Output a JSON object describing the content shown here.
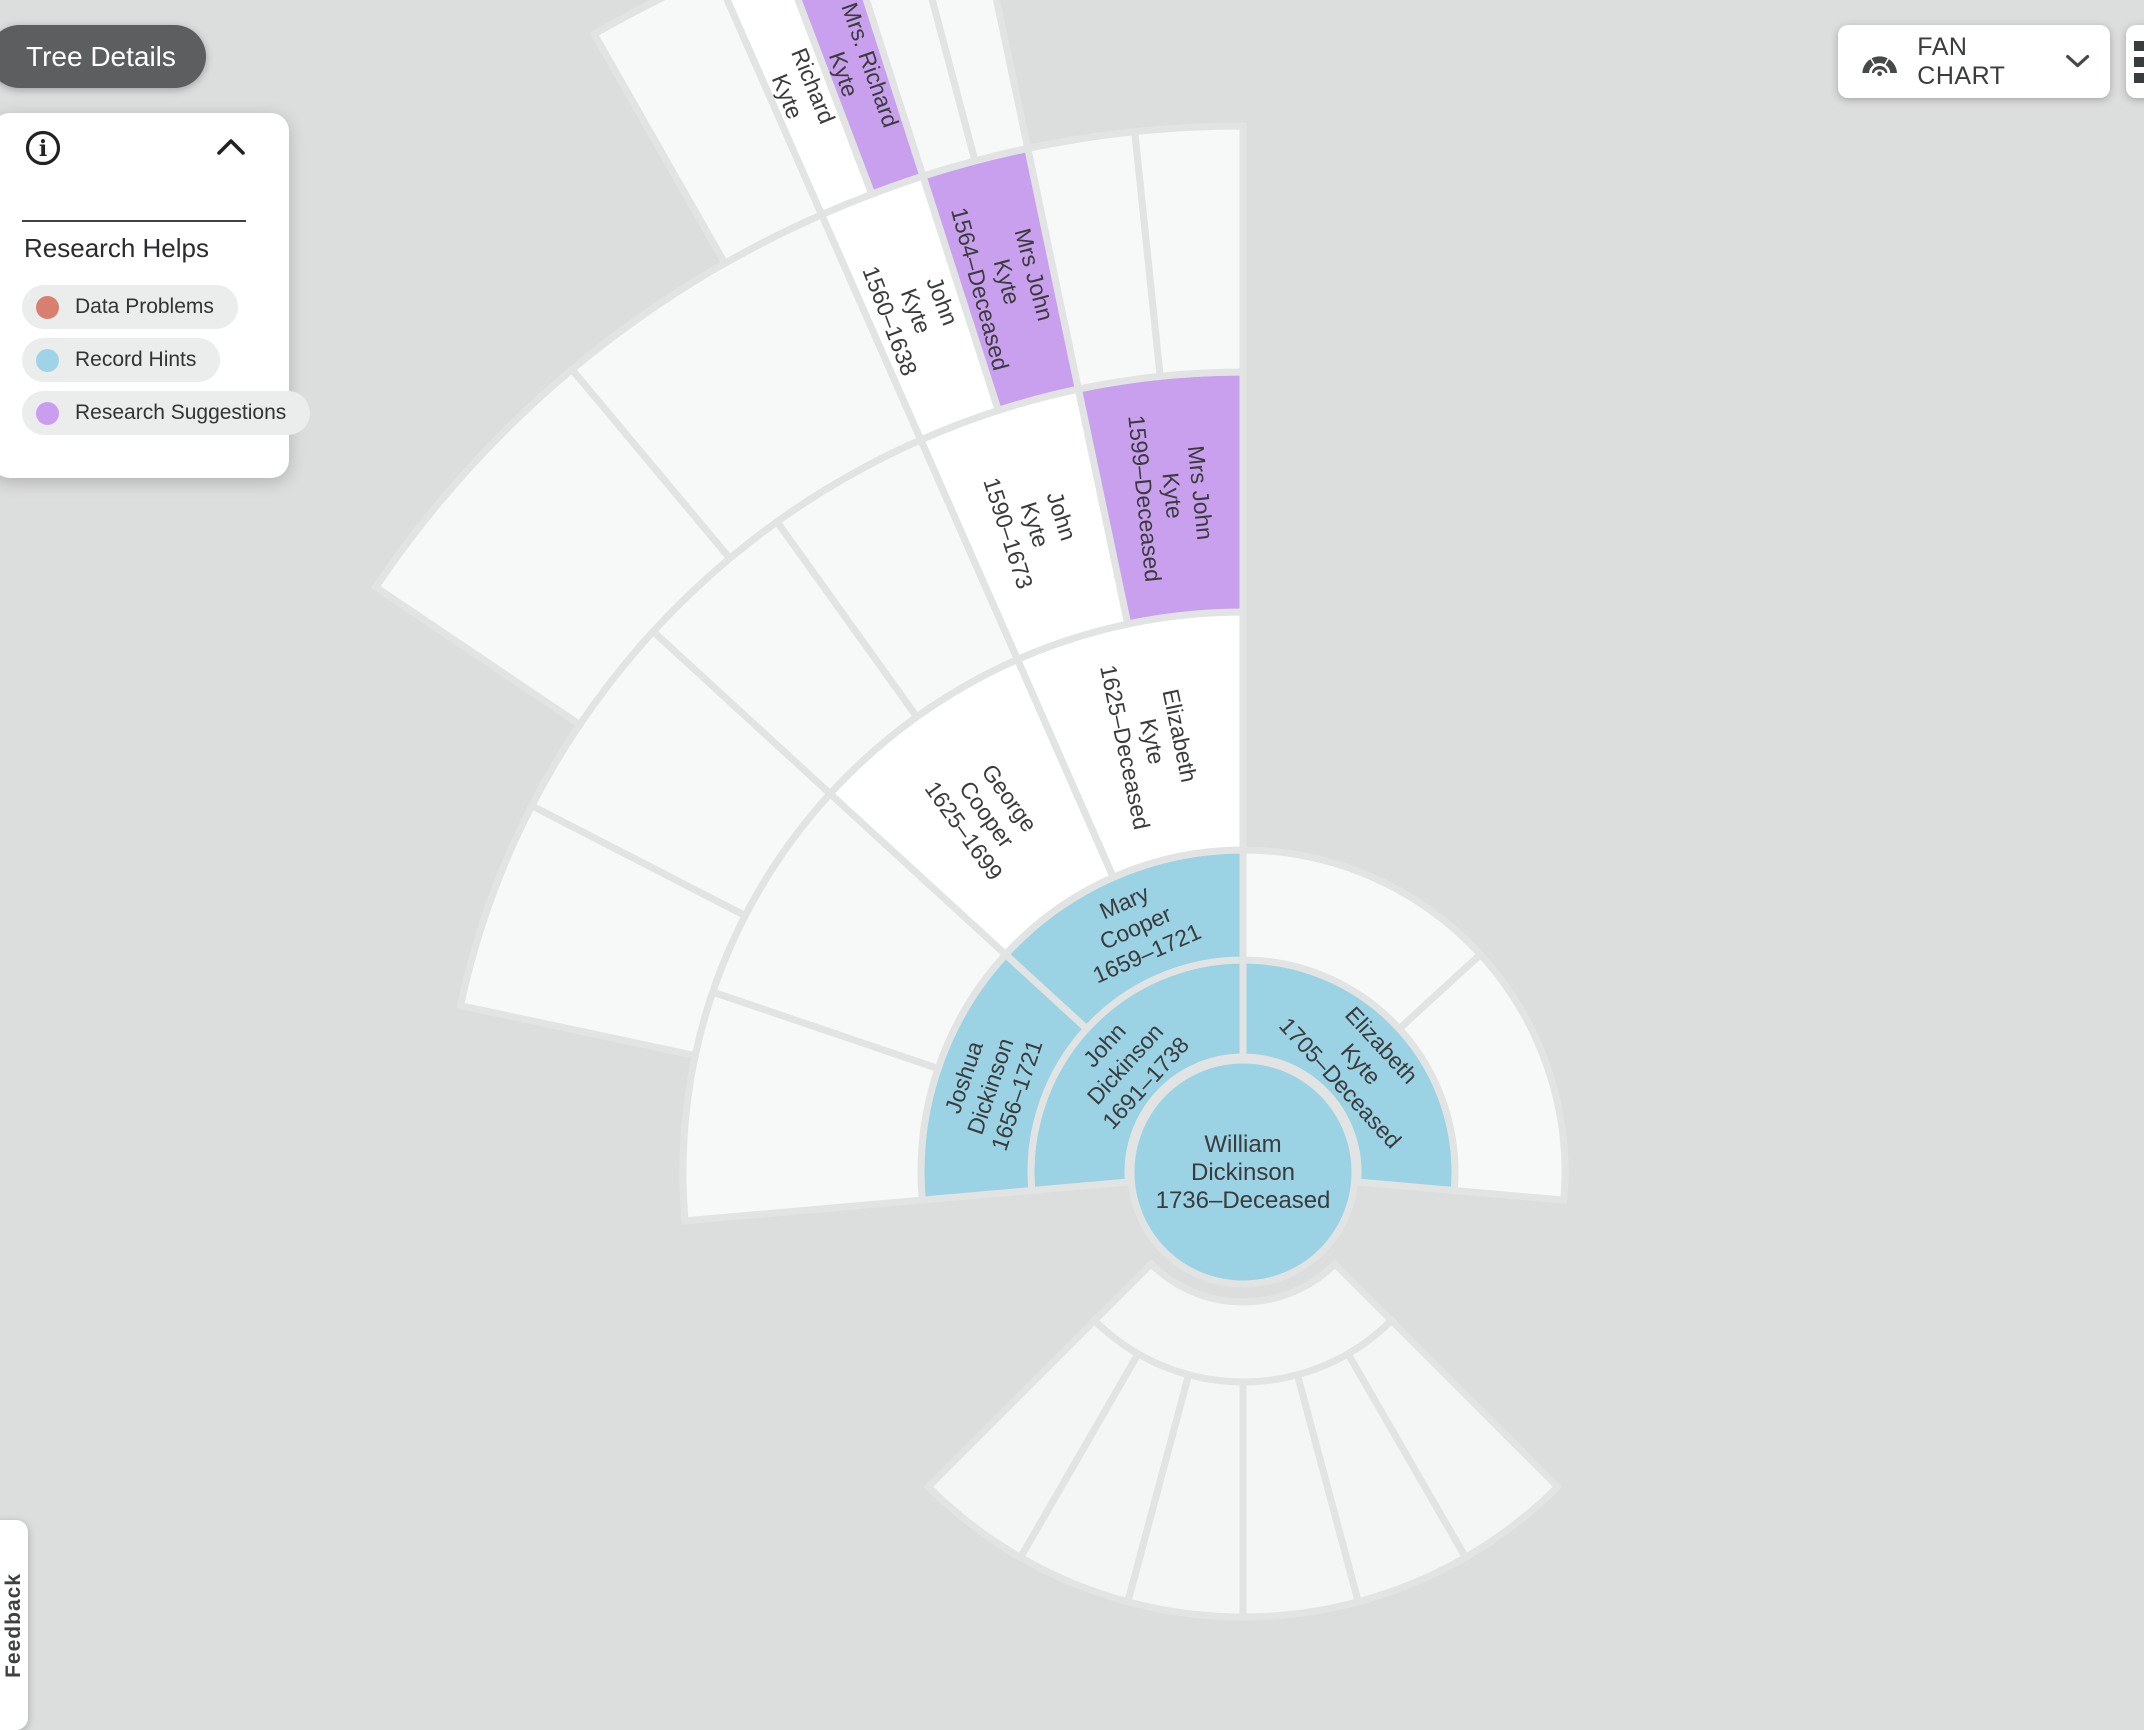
{
  "header": {
    "tree_details_label": "Tree Details",
    "view_selector_label": "FAN CHART"
  },
  "research_helps_panel": {
    "title": "Research Helps",
    "legend": [
      {
        "label": "Data Problems",
        "color": "#d97f70"
      },
      {
        "label": "Record Hints",
        "color": "#9ed3e8"
      },
      {
        "label": "Research Suggestions",
        "color": "#cb9df0"
      }
    ]
  },
  "feedback_tab": {
    "label": "Feedback"
  },
  "fan_chart": {
    "colors": {
      "record_hint": "#9bd2e4",
      "research_suggestion": "#c9a0ee",
      "person": "#ffffff",
      "empty": "#f7f8f8",
      "descendant": "#f4f5f5",
      "stroke": "#e2e4e4",
      "text": "#3a3b3c"
    },
    "center_person": {
      "status": "record_hint",
      "lines": [
        "William",
        "Dickinson",
        "1736–Deceased"
      ]
    },
    "ancestor_segments": [
      {
        "ring": 0,
        "a0": 185,
        "a1": 90,
        "status": "record_hint",
        "lines": [
          "John",
          "Dickinson",
          "1691–1738"
        ]
      },
      {
        "ring": 0,
        "a0": 90,
        "a1": -5,
        "status": "record_hint",
        "lines": [
          "Elizabeth",
          "Kyte",
          "1705–Deceased"
        ]
      },
      {
        "ring": 1,
        "a0": 185,
        "a1": 137.5,
        "status": "record_hint",
        "lines": [
          "Joshua",
          "Dickinson",
          "1656–1721"
        ]
      },
      {
        "ring": 1,
        "a0": 137.5,
        "a1": 90,
        "status": "record_hint",
        "lines": [
          "Mary",
          "Cooper",
          "1659–1721"
        ]
      },
      {
        "ring": 1,
        "a0": 90,
        "a1": 42.5,
        "status": "empty"
      },
      {
        "ring": 1,
        "a0": 42.5,
        "a1": -5,
        "status": "empty"
      },
      {
        "ring": 2,
        "a0": 185,
        "a1": 161.25,
        "status": "empty"
      },
      {
        "ring": 2,
        "a0": 161.25,
        "a1": 137.5,
        "status": "empty"
      },
      {
        "ring": 2,
        "a0": 137.5,
        "a1": 113.75,
        "status": "person",
        "lines": [
          "George",
          "Cooper",
          "1625–1699"
        ]
      },
      {
        "ring": 2,
        "a0": 113.75,
        "a1": 90,
        "status": "person",
        "lines": [
          "Elizabeth",
          "Kyte",
          "1625–Deceased"
        ]
      },
      {
        "ring": 3,
        "a0": 168,
        "a1": 152.75,
        "status": "empty"
      },
      {
        "ring": 3,
        "a0": 152.75,
        "a1": 137.5,
        "status": "empty"
      },
      {
        "ring": 3,
        "a0": 137.5,
        "a1": 125.625,
        "status": "empty"
      },
      {
        "ring": 3,
        "a0": 125.625,
        "a1": 113.75,
        "status": "empty"
      },
      {
        "ring": 3,
        "a0": 113.75,
        "a1": 101.875,
        "status": "person",
        "lines": [
          "John",
          "Kyte",
          "1590–1673"
        ]
      },
      {
        "ring": 3,
        "a0": 101.875,
        "a1": 90,
        "status": "research_suggestion",
        "lines": [
          "Mrs John",
          "Kyte",
          "1599–Deceased"
        ]
      },
      {
        "ring": 4,
        "a0": 146,
        "a1": 129.9,
        "status": "empty"
      },
      {
        "ring": 4,
        "a0": 129.9,
        "a1": 113.75,
        "status": "empty"
      },
      {
        "ring": 4,
        "a0": 113.75,
        "a1": 107.8125,
        "status": "person",
        "lines": [
          "John",
          "Kyte",
          "1560–1638"
        ]
      },
      {
        "ring": 4,
        "a0": 107.8125,
        "a1": 101.875,
        "status": "research_suggestion",
        "lines": [
          "Mrs John",
          "Kyte",
          "1564–Deceased"
        ]
      },
      {
        "ring": 4,
        "a0": 101.875,
        "a1": 95.9375,
        "status": "empty"
      },
      {
        "ring": 4,
        "a0": 95.9375,
        "a1": 90,
        "status": "empty"
      },
      {
        "ring": 5,
        "a0": 119.6875,
        "a1": 113.75,
        "status": "empty"
      },
      {
        "ring": 5,
        "a0": 113.75,
        "a1": 110.78125,
        "status": "person",
        "lines": [
          "Richard",
          "Kyte"
        ]
      },
      {
        "ring": 5,
        "a0": 110.78125,
        "a1": 107.8125,
        "status": "research_suggestion",
        "lines": [
          "Mrs. Richard",
          "Kyte"
        ]
      },
      {
        "ring": 5,
        "a0": 107.8125,
        "a1": 104.84375,
        "status": "empty"
      },
      {
        "ring": 5,
        "a0": 104.84375,
        "a1": 101.875,
        "status": "empty"
      }
    ],
    "descendant_segments": [
      {
        "band": 0,
        "a0": 315,
        "a1": 225,
        "status": "descendant"
      },
      {
        "band": 1,
        "a0": 315,
        "a1": 300,
        "status": "descendant"
      },
      {
        "band": 1,
        "a0": 300,
        "a1": 285,
        "status": "descendant"
      },
      {
        "band": 1,
        "a0": 285,
        "a1": 270,
        "status": "descendant"
      },
      {
        "band": 1,
        "a0": 270,
        "a1": 255,
        "status": "descendant"
      },
      {
        "band": 1,
        "a0": 255,
        "a1": 240,
        "status": "descendant"
      },
      {
        "band": 1,
        "a0": 240,
        "a1": 225,
        "status": "descendant"
      }
    ]
  }
}
